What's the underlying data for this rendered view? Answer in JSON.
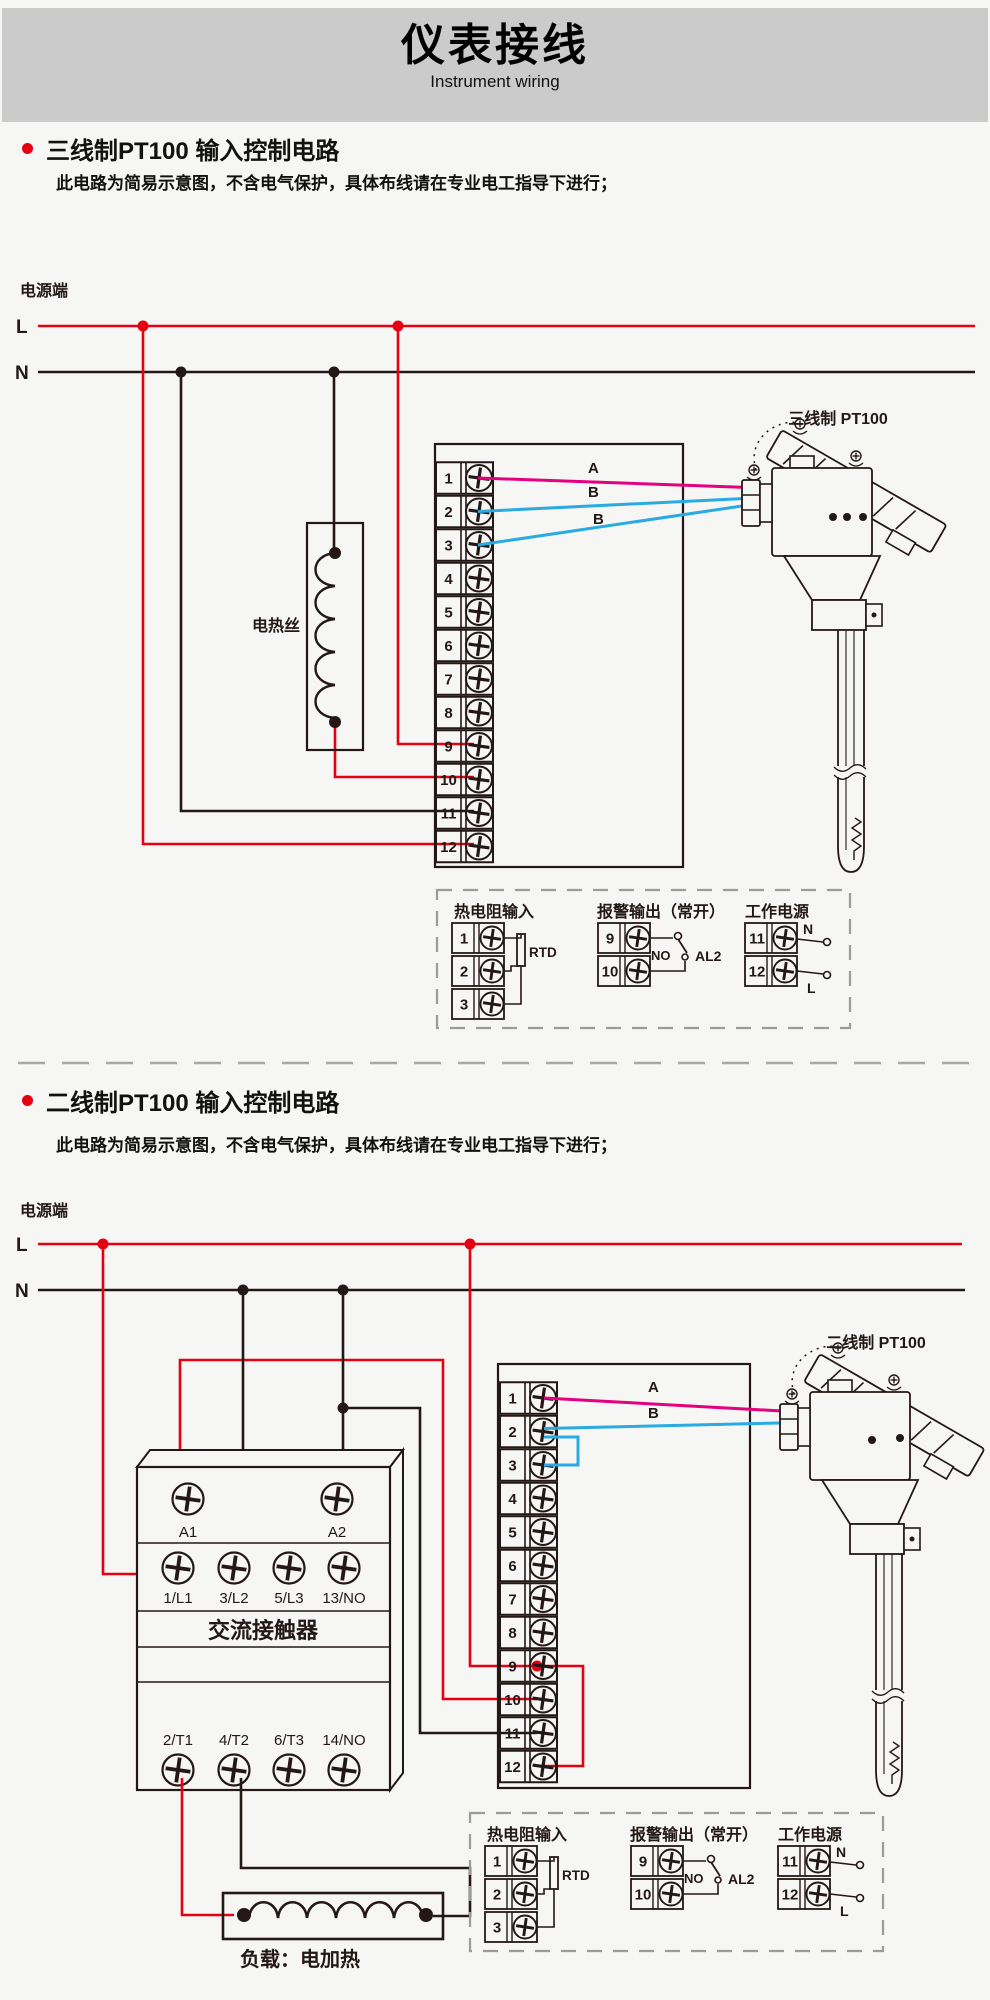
{
  "header": {
    "title": "仪表接线",
    "subtitle": "Instrument wiring"
  },
  "colors": {
    "accent_red": "#e60012",
    "wire_a_magenta": "#e4007f",
    "wire_b_blue": "#29abe2",
    "line_black": "#231815",
    "banner_gray": "#cbcbcb"
  },
  "section1": {
    "title": "三线制PT100 输入控制电路",
    "note": "此电路为简易示意图，不含电气保护，具体布线请在专业电工指导下进行；",
    "power_label": "电源端",
    "l_label": "L",
    "n_label": "N",
    "heater_label": "电热丝",
    "sensor_label": "三线制 PT100",
    "wire_a": "A",
    "wire_b1": "B",
    "wire_b2": "B"
  },
  "section2": {
    "title": "二线制PT100 输入控制电路",
    "note": "此电路为简易示意图，不含电气保护，具体布线请在专业电工指导下进行；",
    "power_label": "电源端",
    "l_label": "L",
    "n_label": "N",
    "sensor_label": "二线制 PT100",
    "wire_a": "A",
    "wire_b": "B",
    "load_label": "负载：电加热",
    "contactor": {
      "name": "交流接触器",
      "a1": "A1",
      "a2": "A2",
      "row2": [
        "1/L1",
        "3/L2",
        "5/L3",
        "13/NO"
      ],
      "row3": [
        "2/T1",
        "4/T2",
        "6/T3",
        "14/NO"
      ]
    }
  },
  "terminal_numbers": [
    "1",
    "2",
    "3",
    "4",
    "5",
    "6",
    "7",
    "8",
    "9",
    "10",
    "11",
    "12"
  ],
  "legend": {
    "rtd_title": "热电阻输入",
    "alarm_title": "报警输出（常开）",
    "power_title": "工作电源",
    "rtd_label": "RTD",
    "no_label": "NO",
    "al2_label": "AL2",
    "n_label": "N",
    "l_label": "L",
    "rtd_terminals": [
      "1",
      "2",
      "3"
    ],
    "alarm_terminals": [
      "9",
      "10"
    ],
    "power_terminals": [
      "11",
      "12"
    ]
  }
}
